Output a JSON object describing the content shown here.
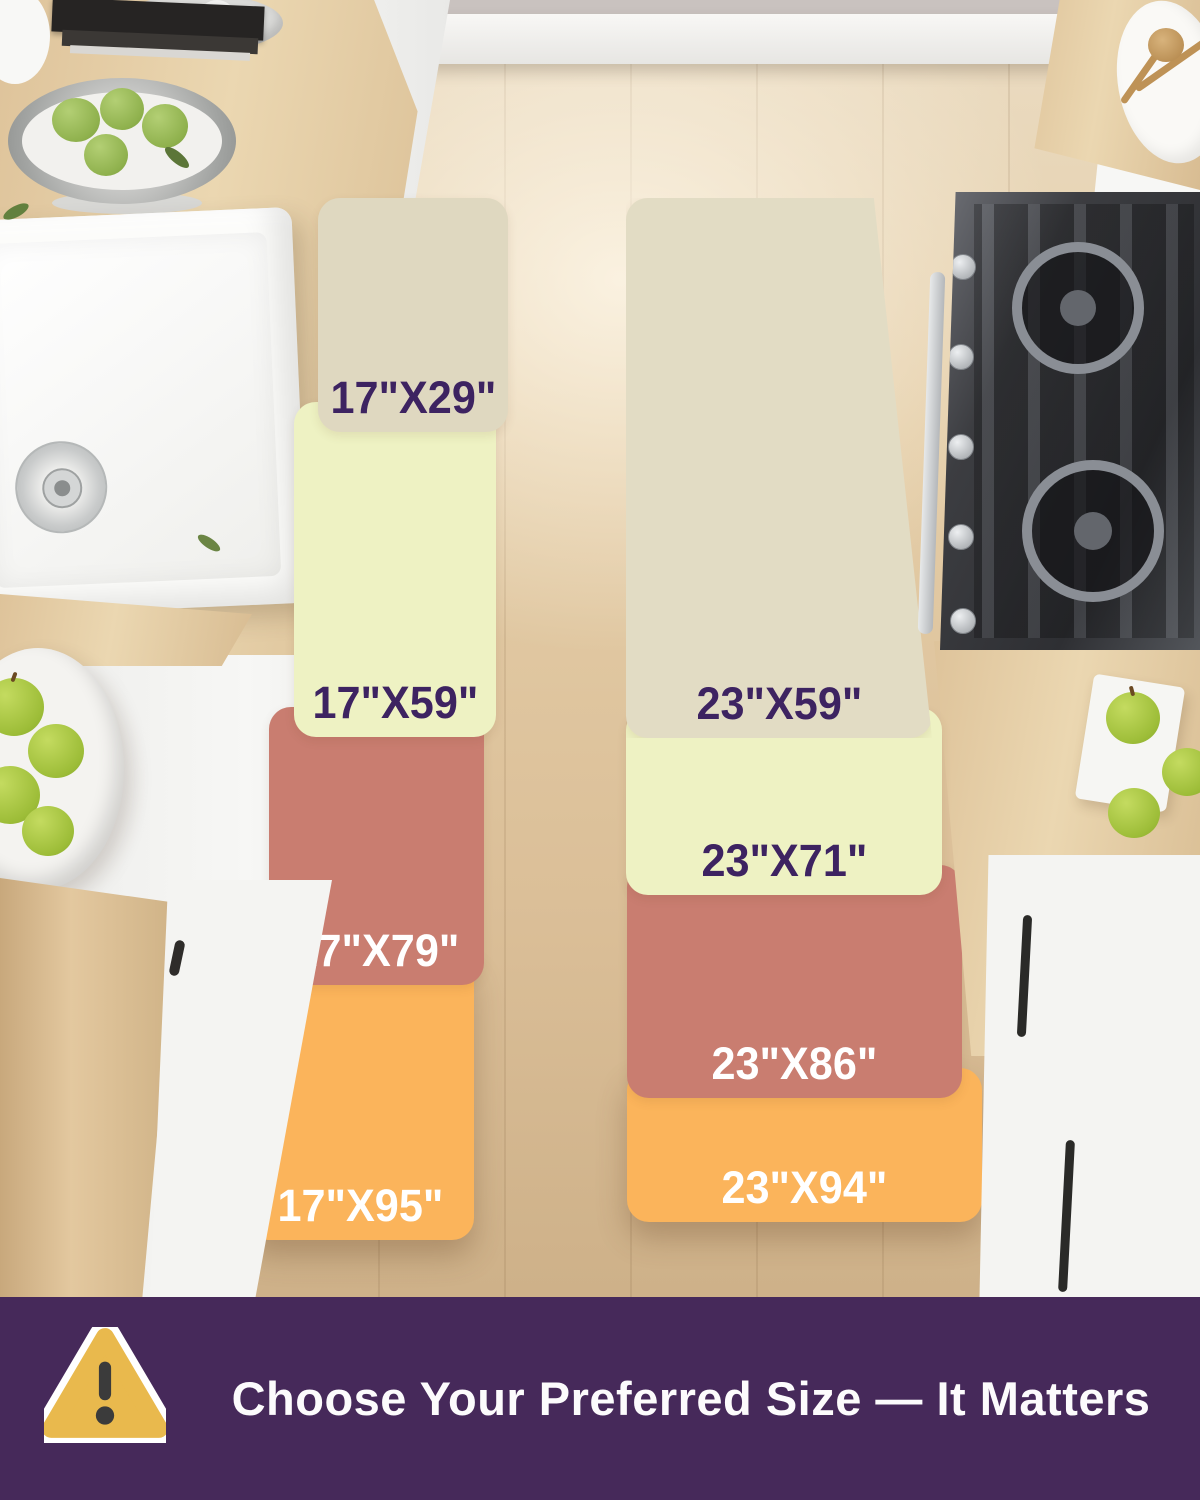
{
  "runners": [
    {
      "name": "17-inch runner",
      "segments": [
        {
          "label": "17\"X29\"",
          "color": "#DFD8C0",
          "label_color": "#3D2361"
        },
        {
          "label": "17\"X59\"",
          "color": "#EEF2C3",
          "label_color": "#3D2361"
        },
        {
          "label": "17\"X79\"",
          "color": "#C97D70",
          "label_color": "#FFFFFF"
        },
        {
          "label": "17\"X95\"",
          "color": "#FBB45B",
          "label_color": "#FFFFFF"
        }
      ]
    },
    {
      "name": "23-inch runner",
      "segments": [
        {
          "label": "23\"X59\"",
          "color": "#E2DCC4",
          "label_color": "#3D2361"
        },
        {
          "label": "23\"X71\"",
          "color": "#EEF2C3",
          "label_color": "#3D2361"
        },
        {
          "label": "23\"X86\"",
          "color": "#C97D70",
          "label_color": "#FFFFFF"
        },
        {
          "label": "23\"X94\"",
          "color": "#FBB45B",
          "label_color": "#FFFFFF"
        }
      ]
    }
  ],
  "banner": {
    "text": "Choose Your Preferred Size — It Matters",
    "background": "#46295A",
    "text_color": "#FCFBFC",
    "icon": {
      "name": "warning-triangle-icon",
      "fill": "#E9B94D",
      "border": "#FFFFFF",
      "mark_color": "#3B3B3B"
    }
  }
}
